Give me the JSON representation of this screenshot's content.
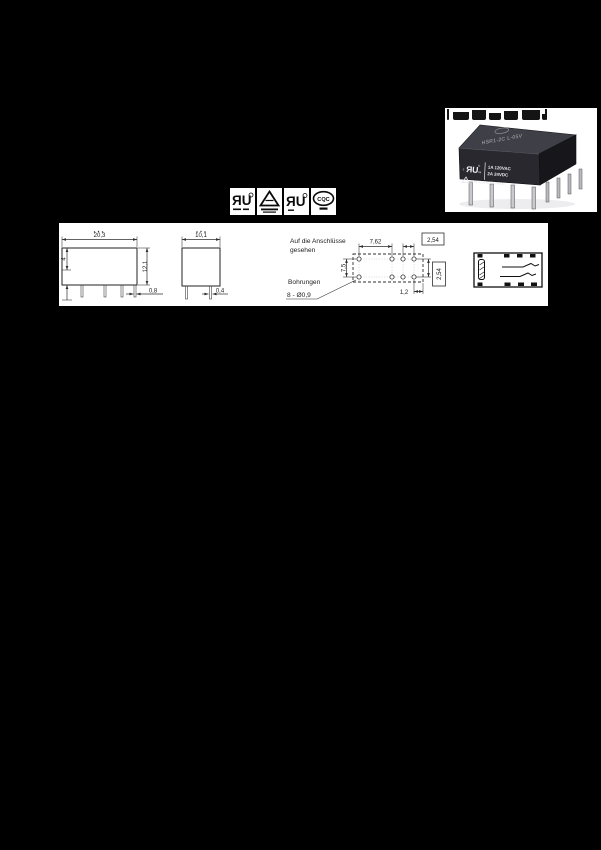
{
  "page": {
    "background": "#000000"
  },
  "product_photo": {
    "top_label": "HSR1-2C  L-05V",
    "front": {
      "ul_c": "c",
      "ul_mark": "ЯU",
      "ul_reg": "®",
      "ul_us": "us",
      "rating1": "1A 120VAC",
      "rating2": "2A  24VDC",
      "rating3": "0.5A 120VAC/1A 24VDC"
    }
  },
  "certifications": [
    {
      "id": "ul-recognized",
      "glyph": "ЯU"
    },
    {
      "id": "vde-triangle",
      "glyph": ""
    },
    {
      "id": "ul-recognized-2",
      "glyph": "ЯU"
    },
    {
      "id": "cqc",
      "glyph": "CQC"
    }
  ],
  "drawing": {
    "notes": {
      "view_line1": "Auf die Anschlüsse",
      "view_line2": "gesehen",
      "holes_title": "Bohrungen",
      "holes_spec": "8 - Ø0,9"
    },
    "dims": {
      "front_width": "20,3",
      "front_height": "12,1",
      "front_side": "4",
      "pin_w_front": "0,8",
      "side_width": "10,1",
      "pin_w_side": "0,4",
      "pitch_a": "7,62",
      "pitch_b": "2,54",
      "row_gap": "7,5",
      "pitch_c": "2,54",
      "edge_off": "1,2"
    }
  }
}
